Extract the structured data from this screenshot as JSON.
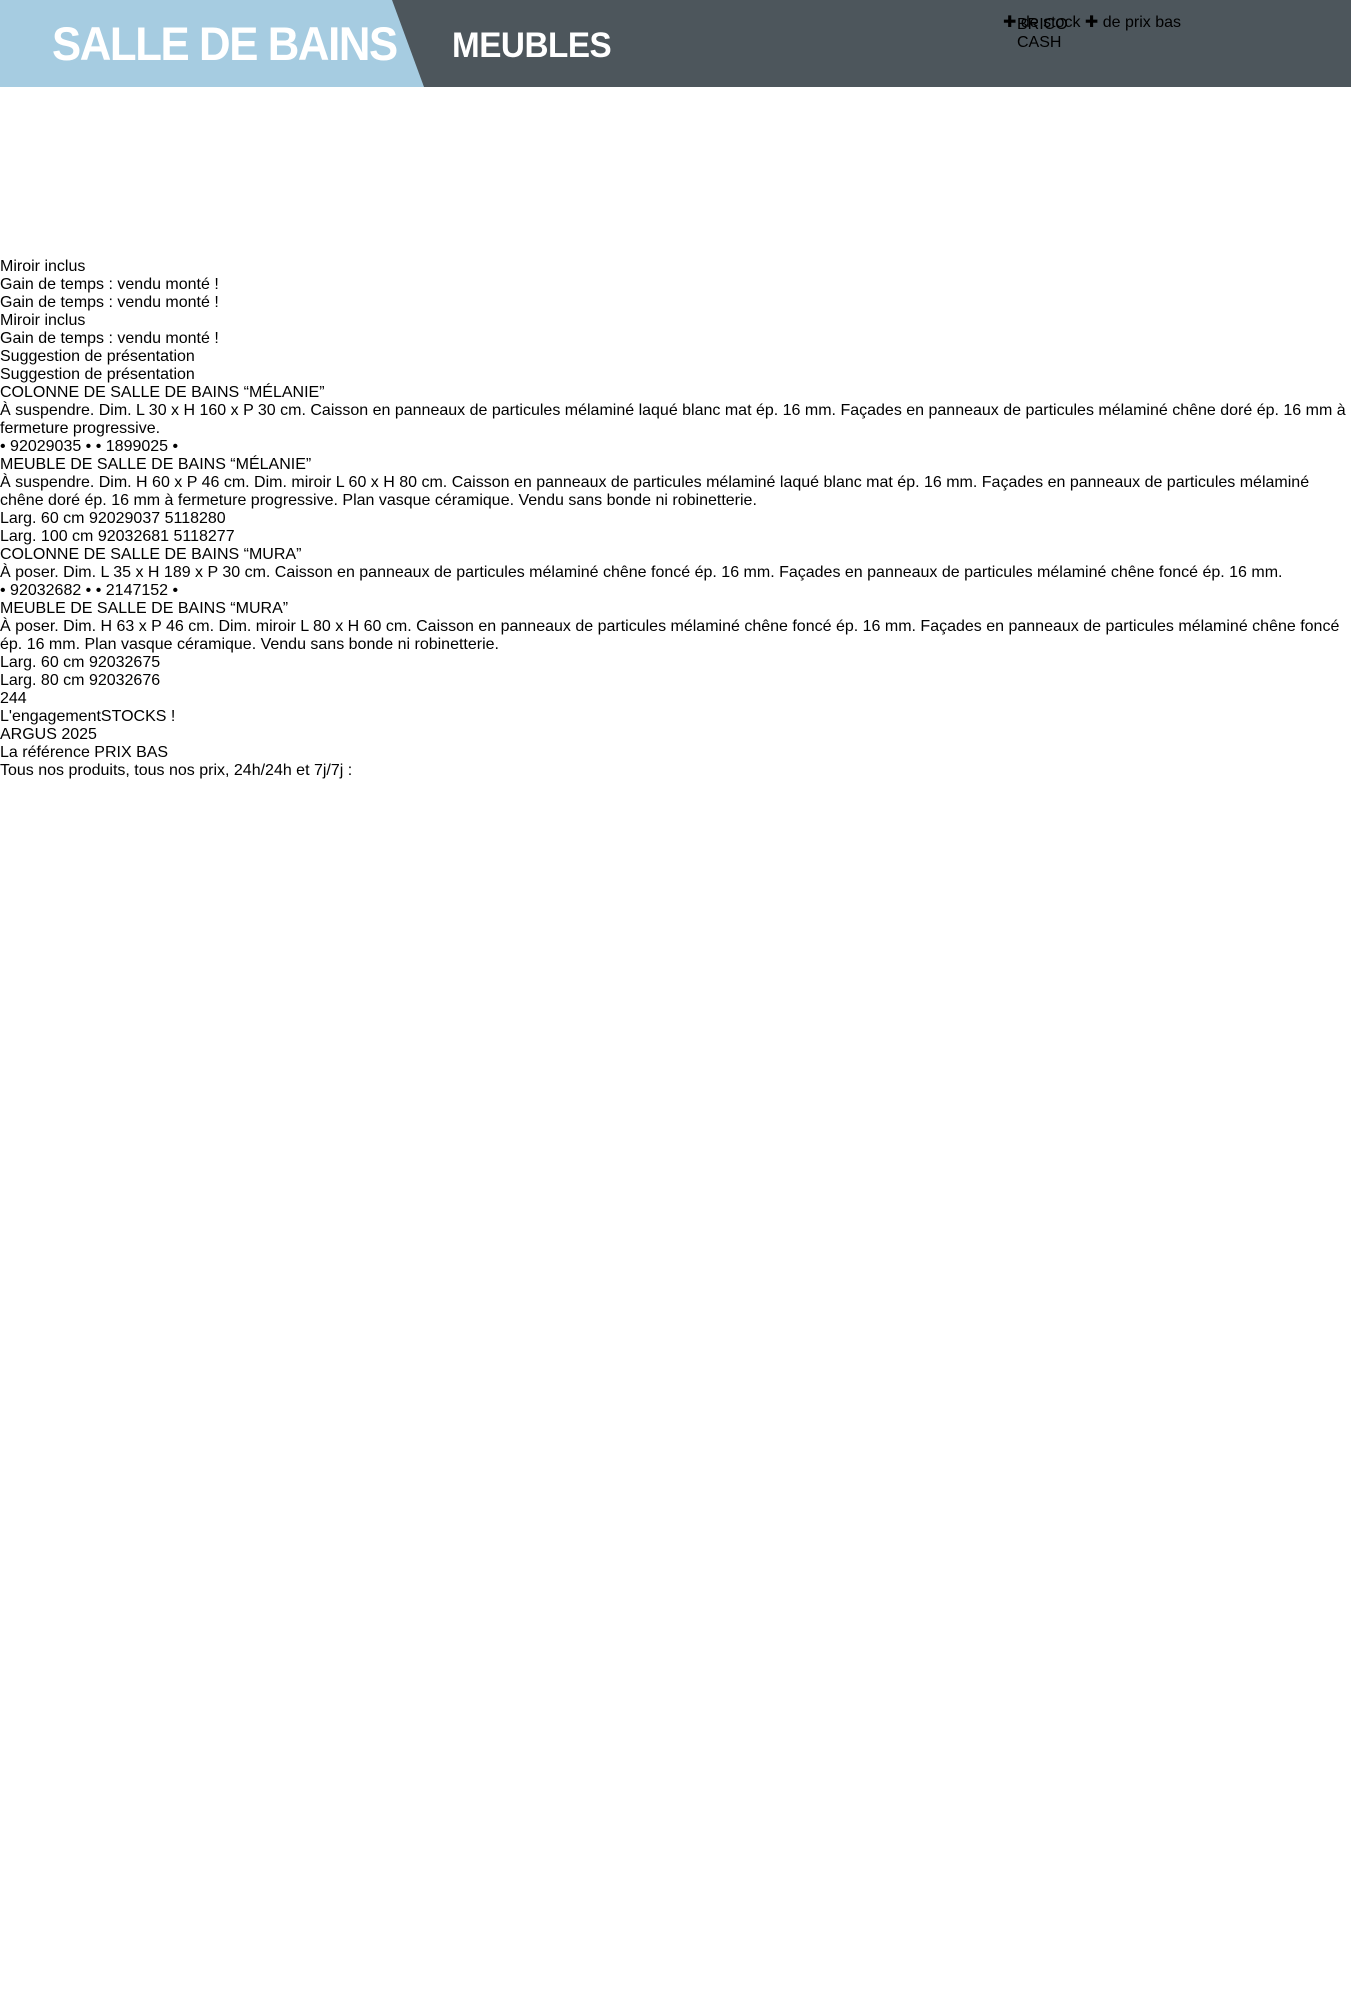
{
  "header": {
    "section": "SALLE DE BAINS",
    "subsection": "MEUBLES",
    "logo": {
      "brand_line1": "BRICO",
      "brand_line2": "CASH",
      "plus": "✚",
      "tagline_part1": "de stock",
      "tagline_part2": "de prix bas"
    }
  },
  "badges": {
    "miroir": "Miroir inclus",
    "gain": "Gain de temps :\nvendu monté !"
  },
  "photo_caption": "Suggestion de présentation",
  "sections": [
    {
      "banner": "GAMME “MÉLANIE”",
      "products": [
        {
          "title": "COLONNE DE SALLE DE BAINS\n“MÉLANIE”",
          "description": "À suspendre. Dim. L 30 x H 160 x P 30 cm.\nCaisson en panneaux de particules mélaminé\nlaqué blanc mat ép. 16 mm. Façades en panneaux\nde particules mélaminé chêne doré\nép. 16 mm à fermeture progressive.",
          "codes": "• 92029035 • • 1899025 •"
        },
        {
          "title": "MEUBLE DE SALLE DE BAINS\n“MÉLANIE”",
          "description": "À suspendre. Dim. H 60 x P 46 cm.\nDim. miroir L 60 x H 80 cm.\nCaisson en panneaux de particules mélaminé laqué\nblanc mat ép. 16 mm. Façades en panneaux de\nparticules mélaminé chêne doré ép. 16 mm\nà fermeture progressive. Plan vasque céramique.\nVendu sans bonde ni robinetterie.",
          "table": {
            "rows": [
              {
                "label": "Larg. 60 cm",
                "code": "92029037",
                "ref": "5118280"
              },
              {
                "label": "Larg. 100 cm",
                "code": "92032681",
                "ref": "5118277"
              }
            ]
          }
        }
      ]
    },
    {
      "banner": "GAMME “MURA”",
      "products": [
        {
          "title": "COLONNE DE SALLE DE BAINS “MURA”",
          "description": "À poser. Dim. L 35 x H 189 x P 30 cm. Caisson\nen panneaux de particules mélaminé chêne foncé\nép. 16 mm. Façades en panneaux de particules\nmélaminé chêne foncé ép. 16 mm.",
          "codes": "• 92032682 • • 2147152 •"
        },
        {
          "title": "MEUBLE DE SALLE DE BAINS “MURA”",
          "description": "À poser. Dim. H 63 x P 46 cm.\nDim. miroir L 80 x H 60 cm. Caisson en panneaux\nde particules mélaminé chêne foncé ép. 16 mm.\nFaçades en panneaux de particules mélaminé chêne\nfoncé ép. 16 mm. Plan vasque céramique.\nVendu sans bonde ni robinetterie.",
          "table": {
            "rows": [
              {
                "label": "Larg. 60 cm",
                "code": "92032675"
              },
              {
                "label": "Larg. 80 cm",
                "code": "92032676"
              }
            ]
          }
        }
      ]
    }
  ],
  "footer": {
    "page_number": "244",
    "engagement_prefix": "L'engagement",
    "engagement_bold": "STOCKS !",
    "argus_title": "ARGUS 2025",
    "argus_subtitle": "La référence PRIX BAS",
    "right_text": "Tous nos produits, tous nos prix, 24h/24h et 7j/7j :"
  },
  "colors": {
    "header_blue": "#a6cce1",
    "band_gray": "#4d565c",
    "badge_yellow": "#f0b32a",
    "accent_orange": "#f5a11d",
    "logo_blue": "#2f6eae",
    "logo_yellow": "#f2b21c"
  }
}
